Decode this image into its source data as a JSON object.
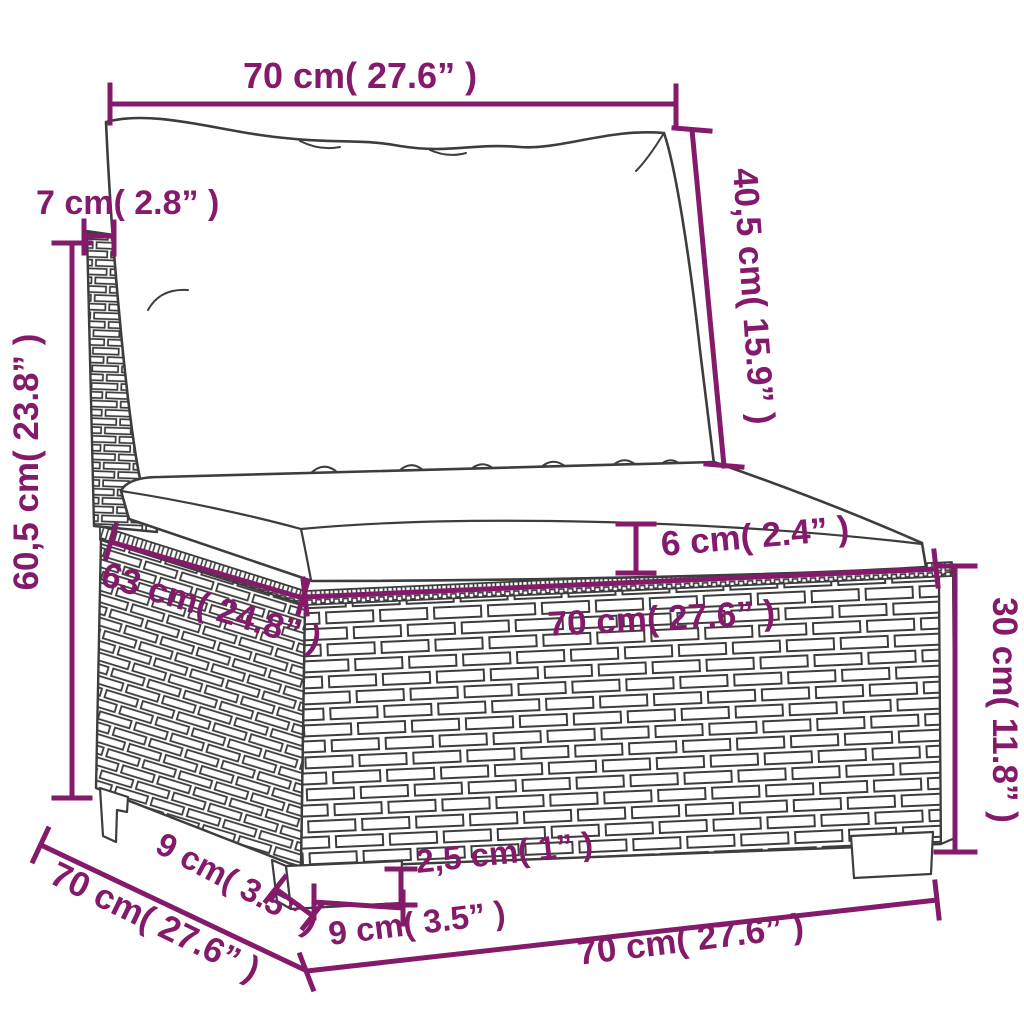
{
  "colors": {
    "dimension": "#841a6a",
    "line_art": "#3d3d3d",
    "background": "#ffffff",
    "fill": "#ffffff"
  },
  "dimensions": {
    "back_cushion_width": "70 cm( 27.6” )",
    "back_panel_thickness": "7 cm( 2.8” )",
    "back_cushion_height": "40,5 cm( 15.9” )",
    "overall_height": "60,5 cm( 23.8” )",
    "seat_cushion_thickness": "6 cm( 2.4” )",
    "seat_width_front": "70 cm( 27.6” )",
    "seat_depth_top": "63 cm( 24.8” )",
    "base_height": "30 cm( 11.8” )",
    "leg_height": "2,5 cm( 1” )",
    "leg_width": "9 cm( 3.5” )",
    "leg_depth": "9 cm( 3.5” )",
    "overall_depth": "70 cm( 27.6” )",
    "overall_width": "70 cm( 27.6” )"
  }
}
